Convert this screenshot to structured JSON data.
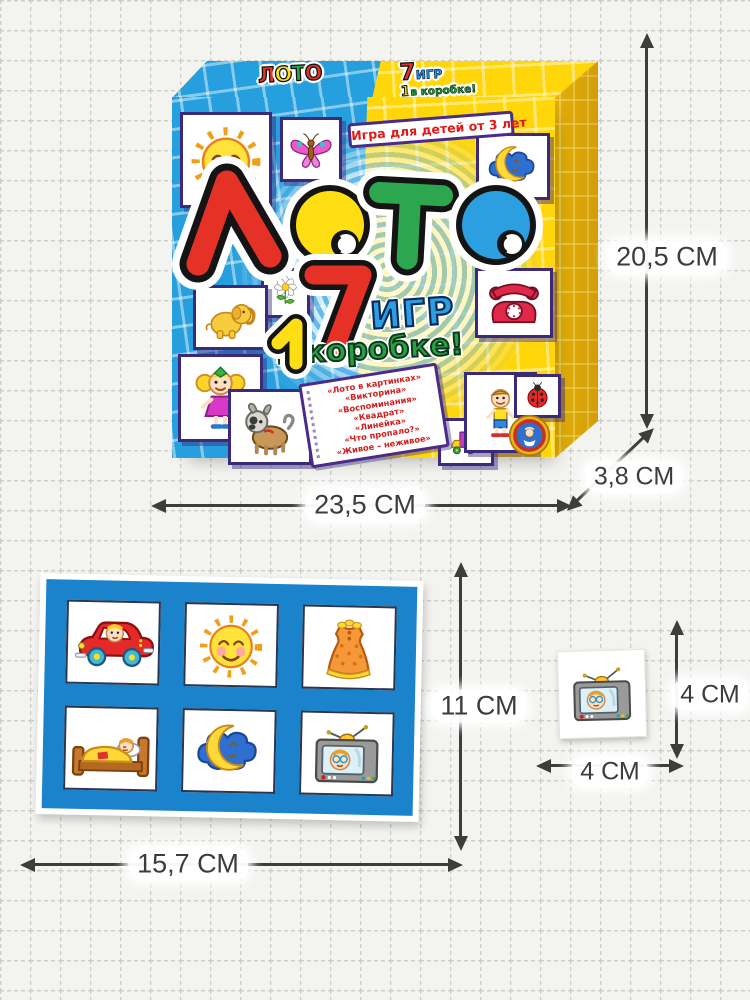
{
  "product": {
    "box": {
      "top": {
        "logo_letters": [
          "Л",
          "О",
          "Т",
          "О"
        ],
        "badge_seven": "7",
        "badge_games": "ИГР",
        "badge_one": "1",
        "badge_in_box": "в коробке!"
      },
      "front": {
        "age_banner": "Игра для детей от 3 лет",
        "title_text": "ЛОТО",
        "count_seven": "7",
        "count_one": "1",
        "games_word": "ИГР",
        "in_box_text": "в коробке!",
        "games_list": [
          "«Лото в картинках»",
          "«Викторина»",
          "«Воспоминания»",
          "«Квадрат»",
          "«Линейка»",
          "«Что пропало?»",
          "«Живое – неживое»"
        ],
        "tile_icons": [
          "sun",
          "butterfly",
          "moon-cloud",
          "flower",
          "elephant",
          "telephone",
          "girl",
          "dog",
          "truck",
          "boy",
          "ladybug"
        ],
        "publisher_logo": "publisher-crest"
      }
    },
    "card": {
      "cell_icons": [
        "car",
        "sun",
        "dress",
        "bed",
        "moon-cloud",
        "tv"
      ]
    },
    "chip": {
      "icon": "tv"
    }
  },
  "dimensions": {
    "box_height": "20,5 СМ",
    "box_width": "23,5 СМ",
    "box_depth": "3,8 СМ",
    "card_height": "11 СМ",
    "card_width": "15,7 СМ",
    "chip_height": "4 СМ",
    "chip_width": "4 СМ"
  },
  "colors": {
    "box_blue": "#259fdd",
    "box_yellow": "#ffd60a",
    "box_side_yellow": "#eab80a",
    "card_blue": "#1b82cc",
    "title_red": "#e63226",
    "title_yellow": "#ffdf13",
    "title_green": "#2ca64f",
    "title_blue": "#2b9fe0",
    "dimension_gray": "#3d3d3d"
  }
}
